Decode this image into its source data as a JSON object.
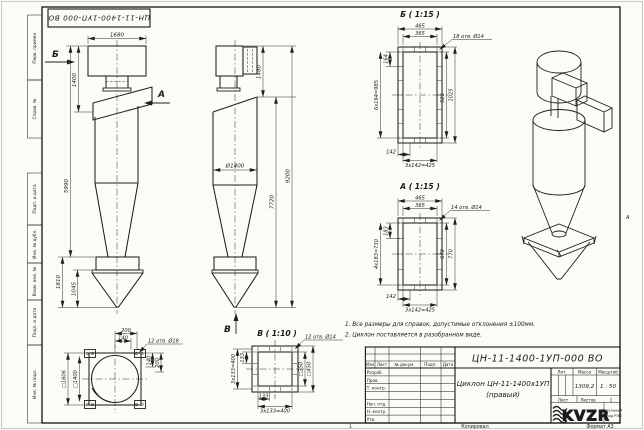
{
  "paper": {
    "stamp_top": "ЦН-11-1400-1УП-000 ВО",
    "zone_marker": "А",
    "bottom": {
      "sheet_num": "1",
      "copied": "Копировал",
      "format": "Формат А3"
    }
  },
  "margin_labels": {
    "perv_primen": "Перв. примен.",
    "sprav_no": "Справ. №",
    "podp_data_1": "Подп. и дата",
    "inv_dubl": "Инв. № дубл.",
    "vzam_inv": "Взам. инв. №",
    "podp_data_2": "Подп. и дата",
    "inv_podl": "Инв. № подл."
  },
  "notes": {
    "line1": "1. Все размеры для справок, допустимые отклонения ±100мм.",
    "line2": "2. Циклон поставляется в разобранном виде."
  },
  "front_view": {
    "label_b": "Б",
    "label_a": "А",
    "dim_width_top": "1680",
    "dim_inlet_height": "1400",
    "dim_body_height": "5990",
    "dim_bunker_height": "1810",
    "dim_bunker_cone": "1045"
  },
  "side_view": {
    "label_v": "В",
    "dim_outlet_height": "1480",
    "dim_total_height": "9200",
    "dim_lower_height": "7720",
    "dim_diameter": "Ø1400"
  },
  "base_view": {
    "dim_200_top": "200",
    "dim_140_top": "140",
    "holes_label": "12 отв. Ø18",
    "dim_sq_outer": "□1606",
    "dim_sq_bolts": "□1400",
    "dim_140_right": "140",
    "dim_200_right": "200"
  },
  "view_v": {
    "title": "В ( 1:10 )",
    "holes_label": "12 отв. Ø14",
    "dim_133_left": "133",
    "dim_pitch_left": "3х133=400",
    "dim_133_bottom": "133",
    "dim_pitch_bottom": "3х133=400",
    "dim_sq_bolts": "□350",
    "dim_sq_outer": "□450"
  },
  "view_b": {
    "title": "Б ( 1:15 )",
    "holes_label": "18 отв. Ø14",
    "dim_width_outer": "465",
    "dim_width_bolts": "365",
    "dim_164": "164",
    "dim_pitch_left": "6х164=985",
    "dim_925": "925",
    "dim_1025": "1025",
    "dim_142": "142",
    "dim_pitch_bottom": "3х142=425"
  },
  "view_a": {
    "title": "А ( 1:15 )",
    "holes_label": "14 отв. Ø14",
    "dim_width_outer": "465",
    "dim_width_bolts": "365",
    "dim_183": "183",
    "dim_pitch_left": "4х183=730",
    "dim_670": "670",
    "dim_770": "770",
    "dim_142": "142",
    "dim_pitch_bottom": "3х142=425"
  },
  "title_block": {
    "doc_number": "ЦН-11-1400-1УП-000 ВО",
    "product_title_1": "Циклон ЦН-11-1400х1УП",
    "product_title_2": "(правый)",
    "col_izm": "Изм",
    "col_list": "Лист",
    "col_doc": "№ докум.",
    "col_podp": "Подп.",
    "col_data": "Дата",
    "row_razrab": "Разраб.",
    "row_prov": "Пров.",
    "row_tkontr": "Т. контр.",
    "row_nachotd": "Нач. отд.",
    "row_nkontr": "Н. контр.",
    "row_utv": "Утв.",
    "lit_label": "Лит.",
    "mass_label": "Масса",
    "scale_label": "Масштаб",
    "mass_value": "1309,2",
    "scale_value": "1 : 50",
    "list_label": "Лист",
    "listov_label": "Листов",
    "listov_value": "1",
    "logo_text": "KVZR",
    "logo_sub_1": "Котельный",
    "logo_sub_2": "завод РЭП"
  }
}
